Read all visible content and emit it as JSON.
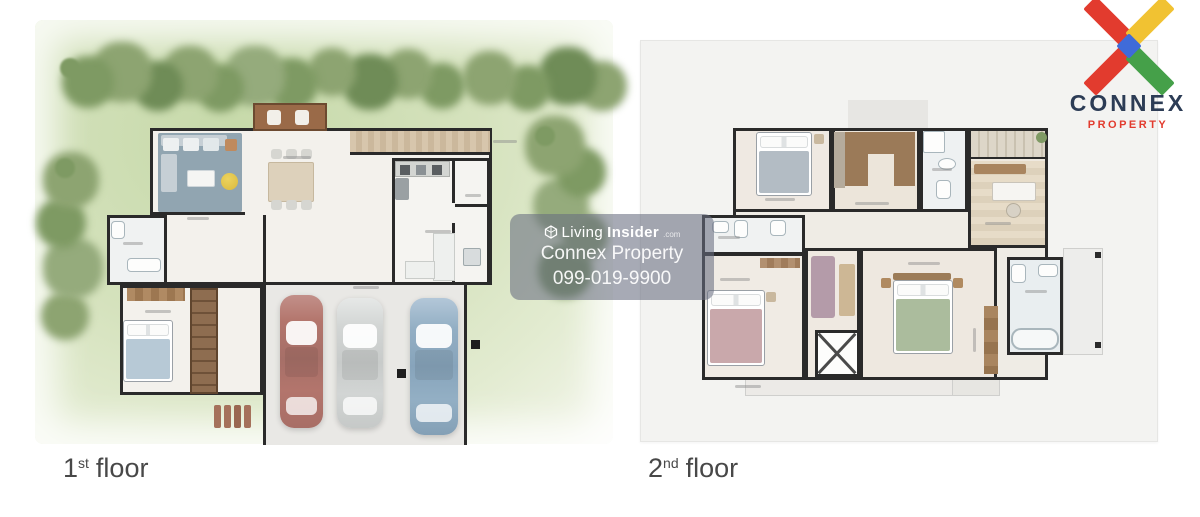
{
  "branding": {
    "brand": "CONNEX",
    "tagline": "PROPERTY",
    "colors": {
      "logo_red": "#e23b2e",
      "logo_yellow": "#f1c232",
      "logo_green": "#45a049",
      "logo_blue": "#3f6bd9",
      "brand_navy": "#2c3c55"
    }
  },
  "watermark": {
    "brand_light": "Living",
    "brand_bold": "Insider",
    "brand_suffix": ".com",
    "company": "Connex Property",
    "phone": "099-019-9900"
  },
  "floors": {
    "first": {
      "number": "1",
      "ordinal": "st",
      "word": "floor"
    },
    "second": {
      "number": "2",
      "ordinal": "nd",
      "word": "floor"
    }
  }
}
